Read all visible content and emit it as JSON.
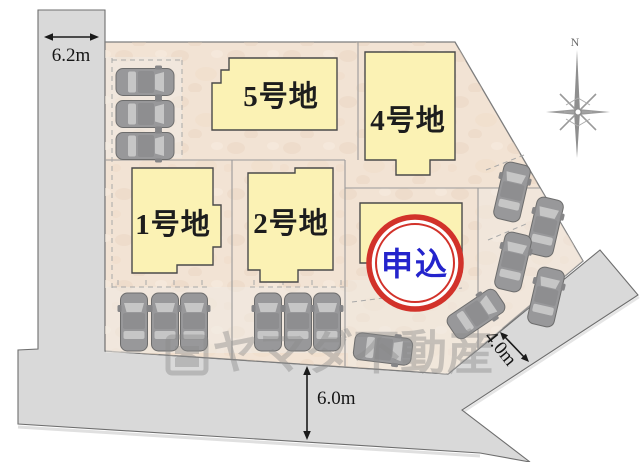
{
  "plots": {
    "p1": {
      "label": "1号地"
    },
    "p2": {
      "label": "2号地"
    },
    "p4": {
      "label": "4号地"
    },
    "p5": {
      "label": "5号地"
    }
  },
  "stamp": {
    "text": "申込",
    "ring_color": "#d2322a",
    "text_color": "#2424cc",
    "fill": "#ffffff"
  },
  "measurements": {
    "left_road": {
      "text": "6.2m"
    },
    "bottom_road": {
      "text": "6.0m"
    },
    "side_road": {
      "text": "4.0m"
    }
  },
  "compass": {
    "label": "N"
  },
  "watermark": {
    "text": "ヤマダ不動産",
    "color": "#8a8a8a"
  },
  "colors": {
    "land": "#f2e3d4",
    "road": "#d9d9d9",
    "road_border": "#6e6e6e",
    "building_fill": "#fbf2b4",
    "building_border": "#4a4a4a",
    "boundary_line": "#9a9a9a",
    "car_body": "#98989a",
    "car_glass": "#c6c6c6"
  },
  "cars": [
    {
      "x": 145,
      "y": 82,
      "r": 90
    },
    {
      "x": 145,
      "y": 114,
      "r": 90
    },
    {
      "x": 145,
      "y": 146,
      "r": 90
    },
    {
      "x": 134,
      "y": 322,
      "r": 0
    },
    {
      "x": 165,
      "y": 322,
      "r": 0
    },
    {
      "x": 194,
      "y": 322,
      "r": 0
    },
    {
      "x": 268,
      "y": 322,
      "r": 0
    },
    {
      "x": 298,
      "y": 322,
      "r": 0
    },
    {
      "x": 327,
      "y": 322,
      "r": 0
    },
    {
      "x": 383,
      "y": 349,
      "r": 97
    },
    {
      "x": 476,
      "y": 314,
      "r": 56
    },
    {
      "x": 512,
      "y": 192,
      "r": 13
    },
    {
      "x": 545,
      "y": 227,
      "r": 13
    },
    {
      "x": 513,
      "y": 262,
      "r": 13
    },
    {
      "x": 546,
      "y": 297,
      "r": 13
    }
  ]
}
